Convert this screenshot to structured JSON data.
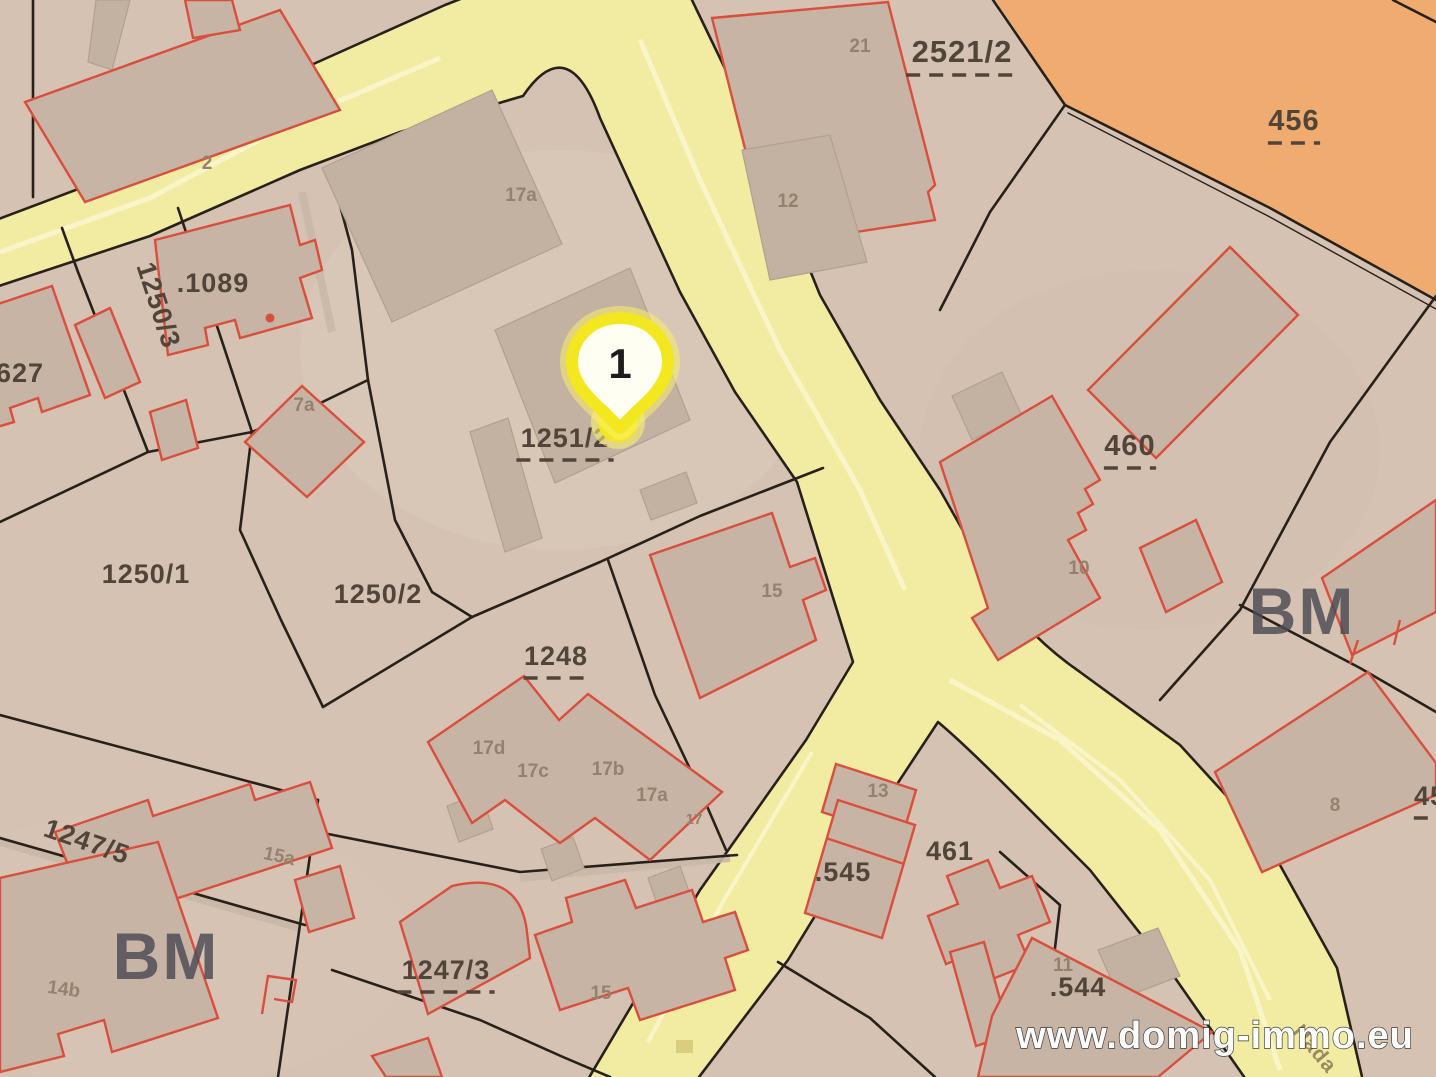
{
  "map": {
    "type": "cadastral-parcel-map",
    "marker": {
      "number": "1"
    },
    "watermark": {
      "text": "www.domig-immo.eu"
    },
    "street": {
      "name": "Hada"
    }
  },
  "colors": {
    "parcel_base": "#d5c2b2",
    "parcel_light": "#dccaba",
    "road_fill": "#f2eca2",
    "road_stripe": "#f9f5c8",
    "line": "#27211a",
    "building_fill": "#c8b4a4",
    "building_gray": "#c3b1a1",
    "building_red": "#d94e3c",
    "orange_parcel": "#efab70",
    "label_dark": "#51453a",
    "label_light": "#94826f",
    "label_region": "#4b4b54",
    "marker_yellow": "#f3e71f",
    "marker_glow": "#f7f06e",
    "watermark_fill": "#ffffff"
  },
  "labels": [
    {
      "text": ".1089",
      "x": 213,
      "y": 292,
      "kind": "parcel"
    },
    {
      "text": "1250/3",
      "x": 150,
      "y": 308,
      "kind": "parcel",
      "rot": 72
    },
    {
      "text": "627",
      "x": 20,
      "y": 382,
      "kind": "parcel"
    },
    {
      "text": "1250/1",
      "x": 146,
      "y": 583,
      "kind": "parcel"
    },
    {
      "text": "1250/2",
      "x": 378,
      "y": 603,
      "kind": "parcel"
    },
    {
      "text": "1251/2",
      "x": 565,
      "y": 447,
      "kind": "parcel",
      "underline": true
    },
    {
      "text": "1248",
      "x": 556,
      "y": 665,
      "kind": "parcel",
      "underline": true
    },
    {
      "text": "1247/5",
      "x": 84,
      "y": 850,
      "kind": "parcel",
      "rot": 19
    },
    {
      "text": "1247/3",
      "x": 446,
      "y": 979,
      "kind": "parcel",
      "underline": true
    },
    {
      "text": ".545",
      "x": 843,
      "y": 881,
      "kind": "parcel"
    },
    {
      "text": "461",
      "x": 950,
      "y": 860,
      "kind": "parcel"
    },
    {
      "text": ".544",
      "x": 1078,
      "y": 996,
      "kind": "parcel"
    },
    {
      "text": "2521/2",
      "x": 962,
      "y": 62,
      "kind": "parcel",
      "underline": true,
      "size": 31
    },
    {
      "text": "456",
      "x": 1294,
      "y": 130,
      "kind": "parcel",
      "underline": true,
      "size": 29
    },
    {
      "text": "460",
      "x": 1130,
      "y": 455,
      "kind": "parcel",
      "underline": true,
      "size": 29
    },
    {
      "text": "45",
      "x": 1430,
      "y": 805,
      "kind": "parcel",
      "underline": true
    },
    {
      "text": "2",
      "x": 207,
      "y": 169,
      "kind": "building"
    },
    {
      "text": "21",
      "x": 860,
      "y": 52,
      "kind": "building"
    },
    {
      "text": "12",
      "x": 788,
      "y": 207,
      "kind": "building"
    },
    {
      "text": "17a",
      "x": 521,
      "y": 201,
      "kind": "building"
    },
    {
      "text": "7a",
      "x": 304,
      "y": 411,
      "kind": "building"
    },
    {
      "text": "15",
      "x": 772,
      "y": 597,
      "kind": "building"
    },
    {
      "text": "10",
      "x": 1079,
      "y": 574,
      "kind": "building"
    },
    {
      "text": "17d",
      "x": 489,
      "y": 754,
      "kind": "building"
    },
    {
      "text": "17c",
      "x": 533,
      "y": 777,
      "kind": "building"
    },
    {
      "text": "17b",
      "x": 608,
      "y": 775,
      "kind": "building"
    },
    {
      "text": "17a",
      "x": 652,
      "y": 801,
      "kind": "building"
    },
    {
      "text": "17",
      "x": 694,
      "y": 824,
      "kind": "building",
      "size": 15
    },
    {
      "text": "13",
      "x": 878,
      "y": 797,
      "kind": "building"
    },
    {
      "text": "15a",
      "x": 278,
      "y": 862,
      "kind": "building",
      "rot": 12
    },
    {
      "text": "8",
      "x": 1335,
      "y": 811,
      "kind": "building"
    },
    {
      "text": "14b",
      "x": 63,
      "y": 995,
      "kind": "building",
      "rot": 8
    },
    {
      "text": "15",
      "x": 601,
      "y": 999,
      "kind": "building"
    },
    {
      "text": "11",
      "x": 1063,
      "y": 971,
      "kind": "building"
    },
    {
      "text": "BM",
      "x": 1302,
      "y": 634,
      "kind": "region"
    },
    {
      "text": "BM",
      "x": 166,
      "y": 979,
      "kind": "region"
    }
  ]
}
